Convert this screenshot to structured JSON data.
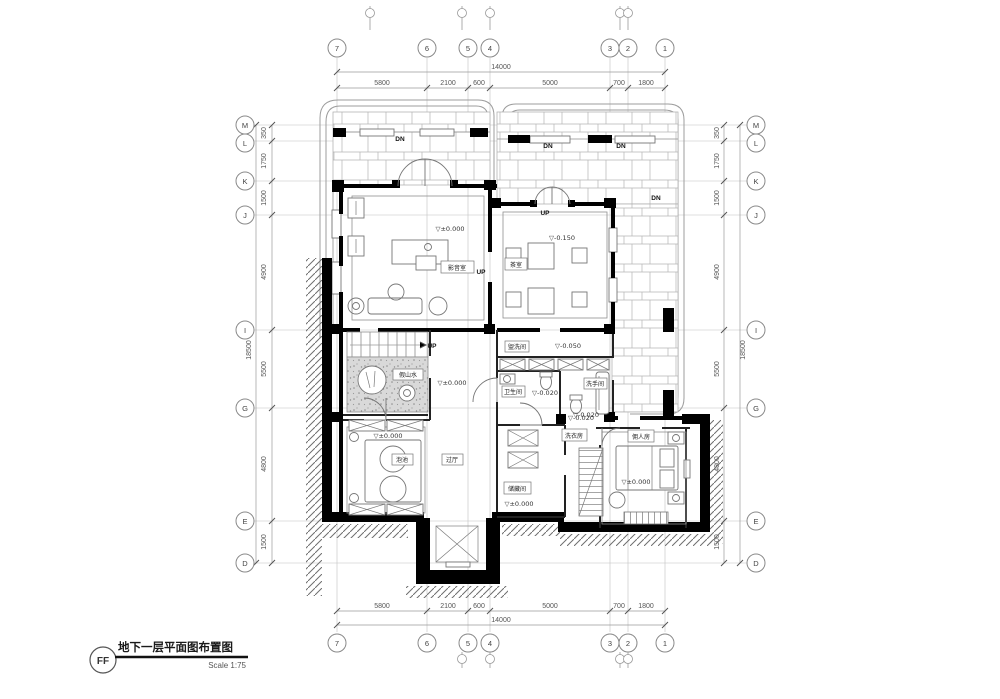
{
  "title_block": {
    "logo": "FF",
    "title": "地下一层平面图布置图",
    "scale": "Scale 1:75"
  },
  "grid": {
    "cols": [
      "7",
      "6",
      "5",
      "4",
      "3",
      "2",
      "1"
    ],
    "rows": [
      "M",
      "L",
      "K",
      "J",
      "I",
      "G",
      "E",
      "D"
    ]
  },
  "dims": {
    "top": [
      "5800",
      "2100",
      "600",
      "5000",
      "700",
      "1800"
    ],
    "top_total": "14000",
    "side": [
      "350",
      "1750",
      "1500",
      "4900",
      "5500",
      "4800",
      "1500"
    ],
    "side_total": "18500"
  },
  "rooms": {
    "media": {
      "label": "影音室",
      "elev": "▽±0.000"
    },
    "tea": {
      "label": "茶室",
      "elev": "▽-0.150"
    },
    "rock": {
      "label": "假山水"
    },
    "hall": {
      "elev": "▽±0.000"
    },
    "wash": {
      "label": "盥洗间",
      "elev": "▽-0.050"
    },
    "bath": {
      "label": "卫生间",
      "elev": "▽-0.020"
    },
    "powder": {
      "label": "洗手间",
      "elev": "▽-0.020"
    },
    "laundry": {
      "label": "洗衣房",
      "elev": "▽-0.020"
    },
    "spa": {
      "label": "泡池",
      "elev": "▽±0.000"
    },
    "foyer": {
      "label": "过厅"
    },
    "storage": {
      "label": "储藏间",
      "elev": "▽±0.000"
    },
    "maid": {
      "label": "佣人房",
      "elev": "▽±0.000"
    }
  },
  "marks": {
    "up": "UP",
    "dn": "DN"
  }
}
